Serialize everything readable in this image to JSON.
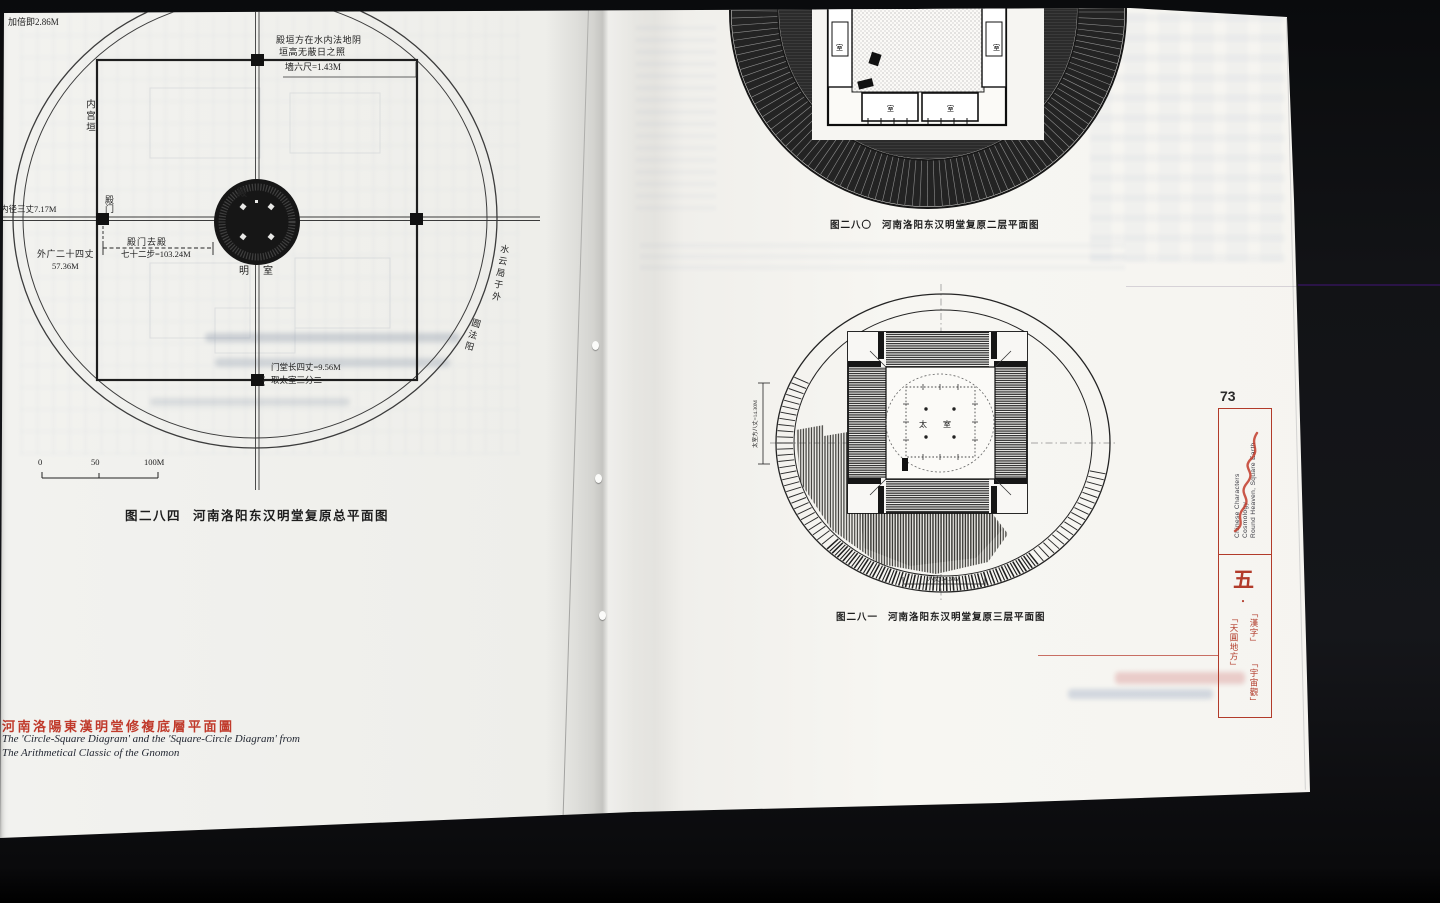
{
  "page": {
    "number": "73"
  },
  "left": {
    "fig284": {
      "no": "图二八四",
      "title": "河南洛阳东汉明堂复原总平面图",
      "topLeft": "加倍即2.86M",
      "note1": "殿垣方在水内法地阴",
      "note2": "垣高无蔽日之照",
      "wallDim": "墙六尺=1.43M",
      "innerWall": "内宫垣",
      "innerDia": "内径三丈7.17M",
      "gate": "殿门",
      "gateToHall1": "殿门去殿",
      "gateToHall2": "七十二步=103.24M",
      "outerWidth1": "外广二十四丈",
      "outerWidth2": "57.36M",
      "hall": "殿",
      "mingshi1": "明",
      "mingshi2": "室",
      "gateHallDim": "门堂长四丈=9.56M",
      "taishiNote": "取太室三分二",
      "moat1": "水云局于外",
      "moat2": "圆法阳",
      "scale0": "0",
      "scale50": "50",
      "scale100": "100M"
    },
    "heading": {
      "zh": "河南洛陽東漢明堂修複底層平面圖",
      "en1": "The 'Circle-Square Diagram' and the 'Square-Circle Diagram' from",
      "en2": "The Arithmetical Classic of the Gnomon"
    }
  },
  "right": {
    "fig280": {
      "no": "图二八〇",
      "title": "河南洛阳东汉明堂复原二层平面图",
      "room": "室"
    },
    "fig281": {
      "no": "图二八一",
      "title": "河南洛阳东汉明堂复原三层平面图",
      "tai": "太",
      "shi": "室",
      "dimLeft": "太室方八丈=14.30M",
      "dimBottom": "八丈  14.30M"
    },
    "sidebar": {
      "en1": "Chinese Characters",
      "en2": "Cosmology",
      "en3": "Round Heaven, Square Earth",
      "num": "五",
      "dot": "・",
      "tagHanzi": "「漢字」",
      "tagCosmos": "「宇宙觀」",
      "tagTianyuan": "「天圓地方」"
    }
  },
  "colors": {
    "accentRed": "#b23b2a",
    "headingRed": "#c03a2b",
    "scanLine": "#2a1447"
  }
}
